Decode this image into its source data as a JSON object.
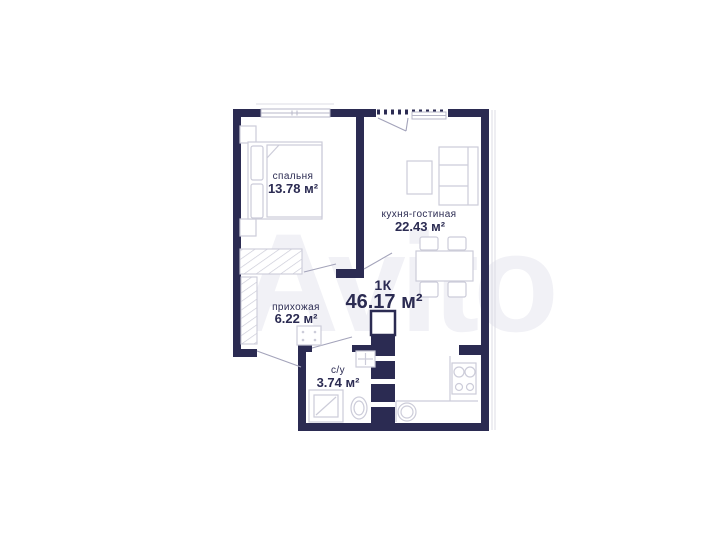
{
  "watermark": {
    "text": "Avito"
  },
  "plan": {
    "unit": {
      "type_label": "1К",
      "total_area": "46.17 м²"
    },
    "rooms": [
      {
        "name": "спальня",
        "area": "13.78 м²"
      },
      {
        "name": "кухня-гостиная",
        "area": "22.43 м²"
      },
      {
        "name": "прихожая",
        "area": "6.22 м²"
      },
      {
        "name": "с/у",
        "area": "3.74 м²"
      }
    ],
    "colors": {
      "wall": "#2b2b52",
      "furniture_outline": "#ccccd9",
      "label_text": "#2b2b52",
      "watermark": "#f1f1f6"
    }
  }
}
